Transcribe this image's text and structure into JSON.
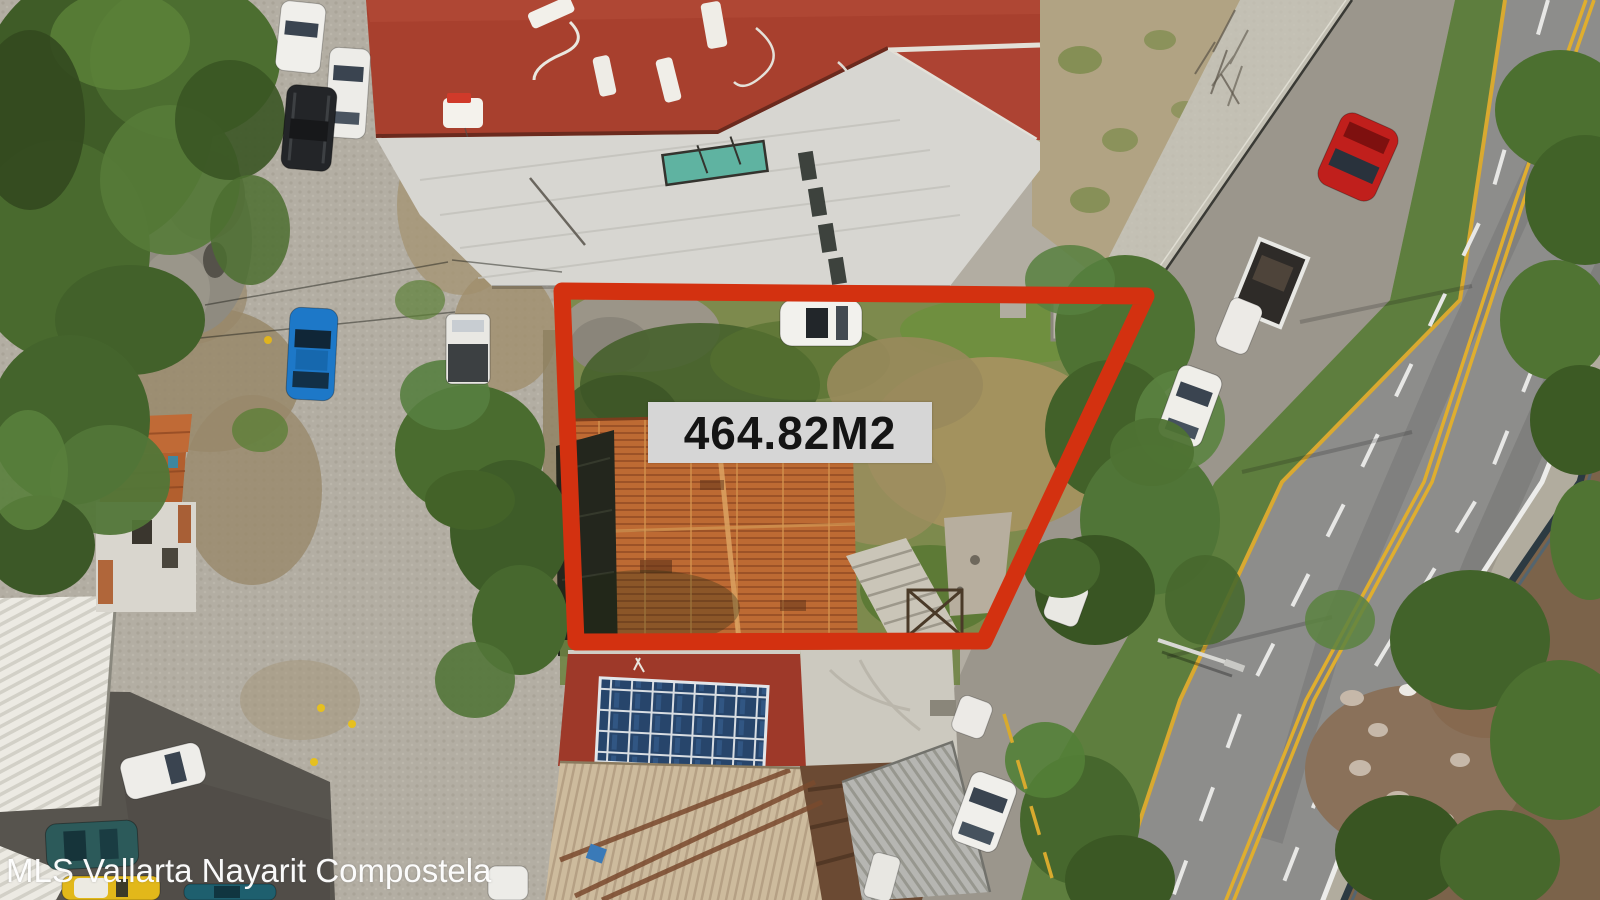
{
  "overlay": {
    "area_label": "464.82M2",
    "outline_color": "#d33110",
    "label_background": "#d6d6d6",
    "label_text_color": "#141414"
  },
  "watermark": {
    "text": "MLS Vallarta Nayarit Compostela",
    "color": "#ffffff"
  },
  "scene_colors": {
    "main_building_roof": "#a8402e",
    "tile_house_roof": "#bd6a33",
    "lot_grass": "#7d8a4d",
    "highway_asphalt": "#8d8d8b",
    "frontage_road": "#9b968c",
    "median_green": "#5e7e3e",
    "ravine_soil": "#7b634a",
    "cobblestone": "#b2ada2",
    "lane_yellow": "#e0ae2e",
    "lane_white": "#ececea"
  }
}
